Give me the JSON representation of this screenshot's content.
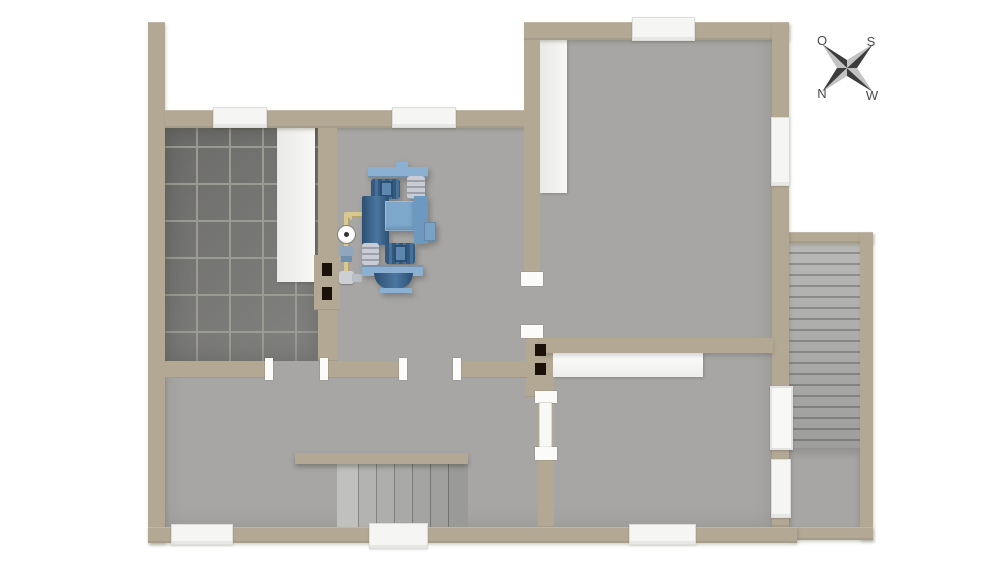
{
  "compass": {
    "o": "O",
    "s": "S",
    "n": "N",
    "w": "W"
  },
  "colors": {
    "exterior": "#ffffff",
    "wall": "#b2a894",
    "floor": "#a7a6a4",
    "tile": "#757573",
    "grout": "#9b9b93",
    "white-fixture": "#f5f5f4",
    "flue": "#19110a",
    "machine-light": "#8cb0d2",
    "machine-mid": "#7da7cb",
    "machine-deep": "#6d99c1",
    "machine-dark": "#33597e",
    "machine-steel": "#c9cdd3",
    "pipe": "#d9c892",
    "compass-dark": "#3d3d3d",
    "compass-light": "#c2c2c2",
    "compass-text": "#4a4a4a"
  },
  "objects": {
    "heating_unit": "boiler-heating-unit",
    "gauge": "pressure-gauge",
    "stairs_exterior": "exterior-staircase",
    "stairs_interior": "interior-staircase"
  }
}
